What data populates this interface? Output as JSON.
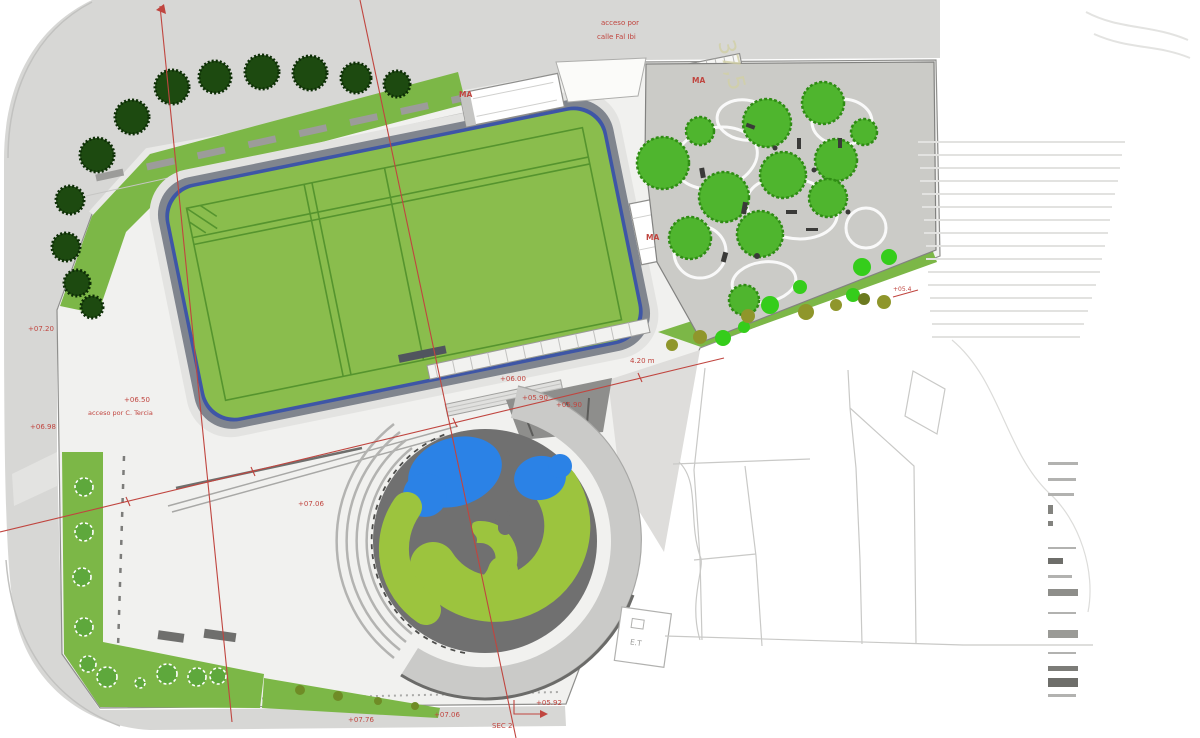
{
  "labels": {
    "access_top_line1": "acceso por",
    "access_top_line2": "calle Fal Ibi",
    "building_ma_north": "MA",
    "building_ma_top": "MA",
    "building_ma_east": "MA",
    "level_left_upper": "+07.20",
    "level_left_lower": "+06.98",
    "level_plaza_access": "+06.50",
    "access_plaza": "acceso por C. Tercia",
    "level_plaza": "+07.06",
    "dim_stand_a": "+06.00",
    "dim_stand_b": "+05.90",
    "dim_stand_c": "+05.90",
    "dim_stand_d": "4.20 m",
    "level_bottom_1": "+07.76",
    "level_bottom_2": "+07.06",
    "section_mark": "SEC 2",
    "level_bottom_3": "+05.92",
    "level_right_edge": "+05.4",
    "transformer": "E.T",
    "road_dim": "37,5"
  },
  "colors": {
    "annotation_red": "#c0453f",
    "field_green": "#8abd4d",
    "field_line_green": "#55942e",
    "perimeter_tree_dark": "#1d4a10",
    "playground_tree_bright": "#4fb52e",
    "swirl_green": "#9cc43e",
    "pond_blue": "#2b82e6",
    "road_gray": "#d7d7d5",
    "site_pavement": "#f1f1ef",
    "playground_gray": "#cbcbc7",
    "plaza_circle_gray": "#707070",
    "planter_green": "#7cb747"
  },
  "legend": {
    "rows": 15
  }
}
